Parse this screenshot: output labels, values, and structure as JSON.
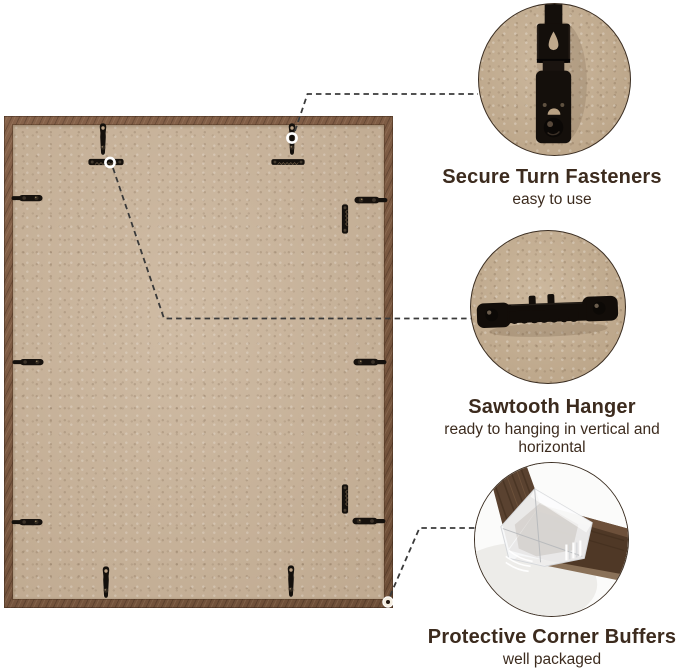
{
  "colors": {
    "background": "#ffffff",
    "text": "#3c2b1e",
    "frame_wood": "#7a5942",
    "backing_board": "#cab49a",
    "closeup_kraft_background": "#c5ae90",
    "hardware_black": "#14100c",
    "leader_line": "#3a3a3a",
    "corner_buffer_white": "#f6f7f9"
  },
  "callouts": [
    {
      "id": "secure-turn-fasteners",
      "icon": "turn-fastener-closeup",
      "title": "Secure Turn Fasteners",
      "subtitle": "easy to use"
    },
    {
      "id": "sawtooth-hanger",
      "icon": "sawtooth-hanger-closeup",
      "title": "Sawtooth Hanger",
      "subtitle": "ready to hanging in vertical and horizontal"
    },
    {
      "id": "protective-corner-buffers",
      "icon": "corner-buffer-closeup",
      "title": "Protective Corner Buffers",
      "subtitle": "well packaged"
    }
  ]
}
